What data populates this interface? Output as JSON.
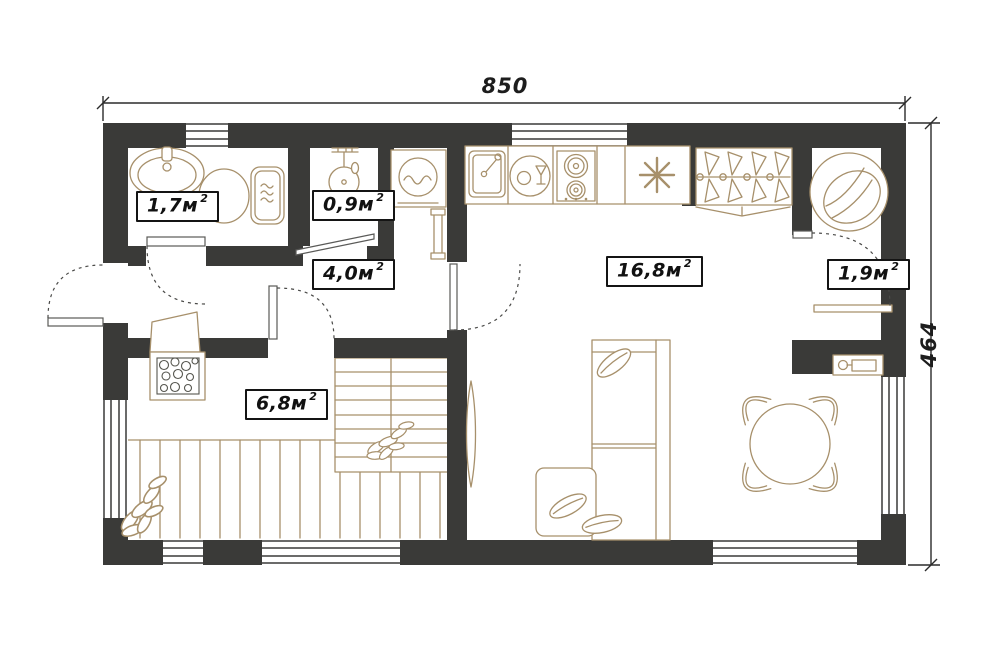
{
  "title": "apartment-floor-plan",
  "dimensions": {
    "top": "850",
    "right": "464"
  },
  "rooms": [
    {
      "id": "bathroom",
      "area": "1,7м",
      "sup": "2"
    },
    {
      "id": "shower-room",
      "area": "0,9м",
      "sup": "2"
    },
    {
      "id": "hallway",
      "area": "4,0м",
      "sup": "2"
    },
    {
      "id": "living-kitchen",
      "area": "16,8м",
      "sup": "2"
    },
    {
      "id": "storage",
      "area": "1,9м",
      "sup": "2"
    },
    {
      "id": "terrace",
      "area": "6,8м",
      "sup": "2"
    }
  ],
  "furniture_icons": [
    "bath-sink-icon",
    "toilet-icon",
    "shower-icon",
    "washing-machine-icon",
    "towel-rail-icon",
    "kitchen-sink-icon",
    "dishwasher-icon",
    "stove-icon",
    "fridge-snowflake-icon",
    "wardrobe-hangers-icon",
    "round-chair-icon",
    "sofa-icon",
    "dining-table-icon",
    "chair-icon",
    "wall-boiler-icon",
    "stairs-icon",
    "grill-stove-icon",
    "plant-leaf-icon",
    "deck-boards",
    "door-swing"
  ],
  "colors": {
    "walls": "#3a3a38",
    "furniture_lines": "#a7906b",
    "annotation": "#2b2b2b",
    "background": "#ffffff"
  }
}
